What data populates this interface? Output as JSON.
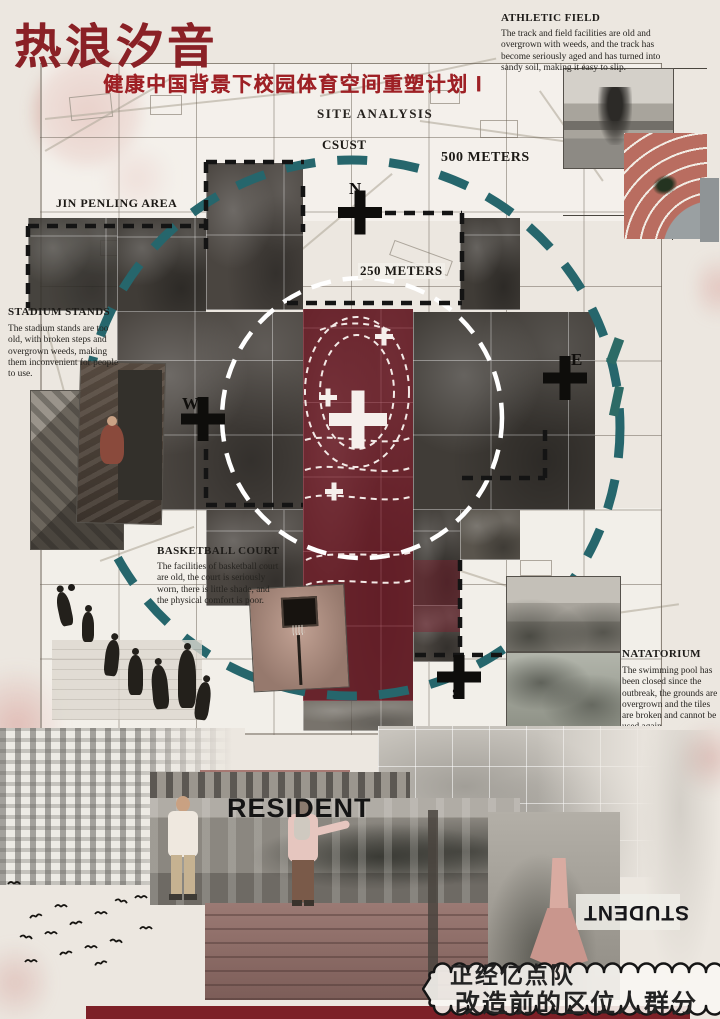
{
  "header": {
    "title": "热浪汐音",
    "subtitle": "健康中国背景下校园体育空间重塑计划 Ⅰ",
    "section_label": "SITE ANALYSIS"
  },
  "map": {
    "labels": {
      "csust": "CSUST",
      "meters_500": "500 METERS",
      "meters_250": "250 METERS",
      "jin_penling": "JIN PENLING AREA"
    },
    "compass": {
      "n": "N",
      "e": "E",
      "w": "W",
      "s": "S"
    }
  },
  "annotations": {
    "athletic_field": {
      "title": "ATHLETIC FIELD",
      "body": "The track and field facilities are old and overgrown with weeds, and the track has become seriously aged and has turned into sandy soil, making it easy to slip."
    },
    "stadium_stands": {
      "title": "STADIUM STANDS",
      "body": "The stadium stands are too old, with broken steps and overgrown weeds, making them inconvenient for people to use."
    },
    "basketball_court": {
      "title": "BASKETBALL COURT",
      "body": "The facilities of basketball court are old, the court is seriously worn, there is little shade, and the physical comfort is poor."
    },
    "natatorium": {
      "title": "NATATORIUM",
      "body": "The swimming pool has been closed since the outbreak, the grounds are overgrown and the tiles are broken and cannot be used again."
    }
  },
  "bottom": {
    "resident": "RESIDENT",
    "student": "STUDENT",
    "bubble_line1": "正经亿点队",
    "bubble_line2": "改造前的区位人群分析"
  },
  "colors": {
    "accent_red": "#8a2126",
    "teal_dash": "#26666c",
    "maroon_zone": "#7c2333",
    "paper": "#ece7e0"
  }
}
